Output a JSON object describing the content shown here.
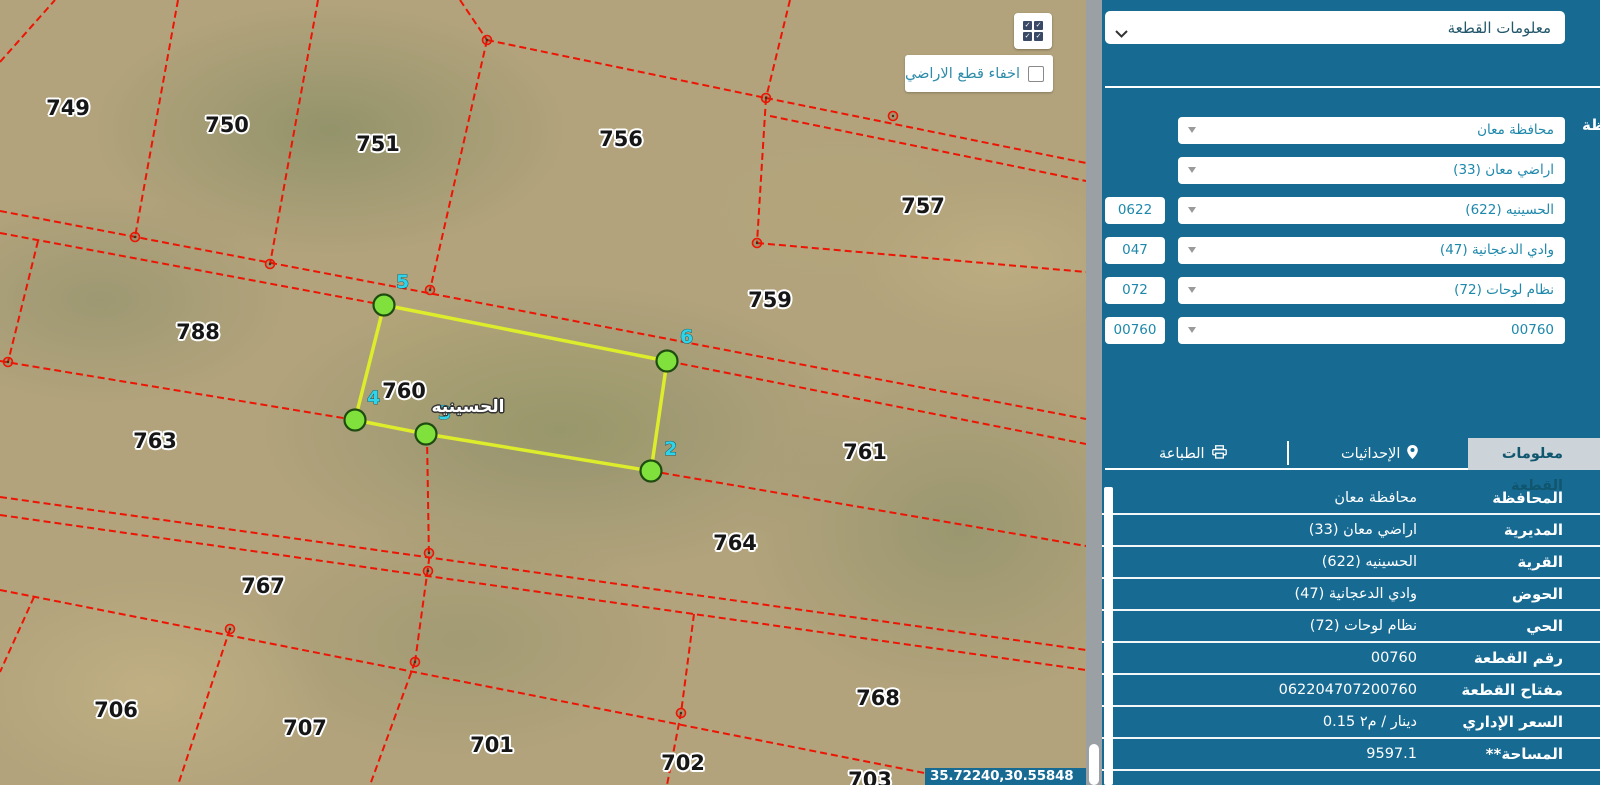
{
  "map": {
    "controls": {
      "hide_parcels_label": "اخفاء قطع الاراضي"
    },
    "coordinates": "35.72240,30.55848",
    "village_label": "الحسينيه",
    "parcels": [
      {
        "n": "749",
        "x": 68,
        "y": 108
      },
      {
        "n": "750",
        "x": 227,
        "y": 125
      },
      {
        "n": "751",
        "x": 378,
        "y": 144
      },
      {
        "n": "756",
        "x": 621,
        "y": 139
      },
      {
        "n": "757",
        "x": 923,
        "y": 206
      },
      {
        "n": "759",
        "x": 770,
        "y": 300
      },
      {
        "n": "788",
        "x": 198,
        "y": 332
      },
      {
        "n": "760",
        "x": 404,
        "y": 391
      },
      {
        "n": "763",
        "x": 155,
        "y": 441
      },
      {
        "n": "761",
        "x": 865,
        "y": 452
      },
      {
        "n": "764",
        "x": 735,
        "y": 543
      },
      {
        "n": "767",
        "x": 263,
        "y": 586
      },
      {
        "n": "706",
        "x": 116,
        "y": 710
      },
      {
        "n": "707",
        "x": 305,
        "y": 728
      },
      {
        "n": "701",
        "x": 492,
        "y": 745
      },
      {
        "n": "702",
        "x": 683,
        "y": 763
      },
      {
        "n": "768",
        "x": 878,
        "y": 698
      },
      {
        "n": "703",
        "x": 870,
        "y": 780
      }
    ],
    "vertex_labels": [
      {
        "n": "5",
        "x": 384,
        "y": 305,
        "lx": 396,
        "ly": 288
      },
      {
        "n": "6",
        "x": 667,
        "y": 361,
        "lx": 680,
        "ly": 343
      },
      {
        "n": "2",
        "x": 651,
        "y": 471,
        "lx": 664,
        "ly": 455
      },
      {
        "n": "3",
        "x": 426,
        "y": 434,
        "lx": 438,
        "ly": 419
      },
      {
        "n": "4",
        "x": 355,
        "y": 420,
        "lx": 367,
        "ly": 404
      }
    ],
    "geometry": {
      "parcel_polygon": [
        [
          384,
          305
        ],
        [
          667,
          361
        ],
        [
          651,
          471
        ],
        [
          426,
          434
        ],
        [
          355,
          420
        ]
      ],
      "red_polylines": [
        [
          [
            178,
            0
          ],
          [
            135,
            237
          ]
        ],
        [
          [
            318,
            0
          ],
          [
            270,
            264
          ]
        ],
        [
          [
            460,
            0
          ],
          [
            487,
            40
          ]
        ],
        [
          [
            487,
            40
          ],
          [
            766,
            98
          ]
        ],
        [
          [
            790,
            0
          ],
          [
            766,
            98
          ]
        ],
        [
          [
            766,
            98
          ],
          [
            1086,
            163
          ]
        ],
        [
          [
            770,
            116
          ],
          [
            1086,
            181
          ]
        ],
        [
          [
            766,
            98
          ],
          [
            757,
            243
          ]
        ],
        [
          [
            757,
            243
          ],
          [
            1086,
            272
          ]
        ],
        [
          [
            487,
            40
          ],
          [
            430,
            290
          ]
        ],
        [
          [
            0,
            211
          ],
          [
            1086,
            419
          ]
        ],
        [
          [
            0,
            233
          ],
          [
            384,
            305
          ],
          [
            667,
            361
          ],
          [
            1086,
            444
          ]
        ],
        [
          [
            38,
            241
          ],
          [
            8,
            362
          ]
        ],
        [
          [
            0,
            361
          ],
          [
            355,
            420
          ]
        ],
        [
          [
            427,
            436
          ],
          [
            429,
            560
          ],
          [
            415,
            662
          ]
        ],
        [
          [
            230,
            629
          ],
          [
            178,
            785
          ]
        ],
        [
          [
            415,
            662
          ],
          [
            370,
            785
          ]
        ],
        [
          [
            694,
            614
          ],
          [
            681,
            713
          ],
          [
            667,
            785
          ]
        ],
        [
          [
            651,
            471
          ],
          [
            1086,
            546
          ]
        ],
        [
          [
            0,
            497
          ],
          [
            1086,
            650
          ]
        ],
        [
          [
            0,
            515
          ],
          [
            1086,
            670
          ]
        ],
        [
          [
            0,
            590
          ],
          [
            985,
            785
          ]
        ],
        [
          [
            34,
            597
          ],
          [
            0,
            672
          ]
        ],
        [
          [
            0,
            62
          ],
          [
            55,
            0
          ]
        ]
      ],
      "junctions": [
        [
          135,
          237
        ],
        [
          270,
          264
        ],
        [
          430,
          290
        ],
        [
          487,
          40
        ],
        [
          766,
          98
        ],
        [
          893,
          116
        ],
        [
          757,
          243
        ],
        [
          8,
          362
        ],
        [
          230,
          629
        ],
        [
          415,
          662
        ],
        [
          429,
          553
        ],
        [
          428,
          571
        ],
        [
          681,
          713
        ]
      ]
    },
    "colors": {
      "boundary_red": "#ee1404",
      "parcel_yellow": "#dded2b",
      "vertex_green": "#80e03c",
      "vertex_label_cyan": "#2ed4e9"
    }
  },
  "panel": {
    "accent_color": "#176b93",
    "top_select": "معلومات القطعة",
    "partial_label": "ظة",
    "filters": [
      {
        "value": "محافظة معان",
        "badge": ""
      },
      {
        "value": "اراضي معان (33)",
        "badge": ""
      },
      {
        "value": "الحسينيه (622)",
        "badge": "0622"
      },
      {
        "value": "وادي الدعجانية (47)",
        "badge": "047"
      },
      {
        "value": "نظام لوحات (72)",
        "badge": "072"
      },
      {
        "value": "00760",
        "badge": "00760"
      }
    ],
    "tabs": [
      {
        "label": "معلومات القطعة",
        "active": true
      },
      {
        "label": "الإحداثيات",
        "icon": "pin-icon"
      },
      {
        "label": "الطباعة",
        "icon": "printer-icon"
      }
    ],
    "table": [
      {
        "label": "المحافظة",
        "value": "محافظة معان"
      },
      {
        "label": "المديرية",
        "value": "اراضي معان (33)"
      },
      {
        "label": "القرية",
        "value": "الحسينيه (622)"
      },
      {
        "label": "الحوض",
        "value": "وادي الدعجانية (47)"
      },
      {
        "label": "الحي",
        "value": "نظام لوحات (72)"
      },
      {
        "label": "رقم القطعة",
        "value": "00760"
      },
      {
        "label": "مفتاح القطعة",
        "value": "062204707200760"
      },
      {
        "label": "السعر الإداري",
        "value": "0.15 دينار / م٢",
        "ltr": true
      },
      {
        "label": "المساحة**",
        "value": "9597.1"
      }
    ]
  }
}
